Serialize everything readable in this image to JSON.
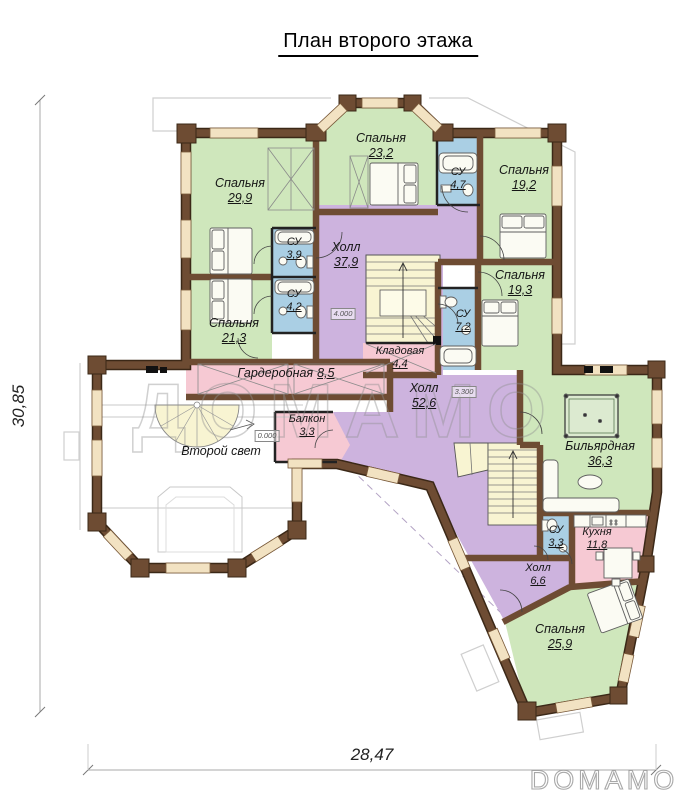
{
  "title": "План второго этажа",
  "dimensions": {
    "left": "30,85",
    "bottom": "28,47"
  },
  "watermark": {
    "center": "ДОМАМО",
    "corner": "DOMAMO"
  },
  "elevations": [
    "4.000",
    "3.300",
    "0.000"
  ],
  "colors": {
    "wall": "#6e4c33",
    "wall_edge": "#3b2817",
    "bedroom": "#cfe7bc",
    "hall": "#cdb3de",
    "bathroom": "#aacfe4",
    "service": "#f6c9d3",
    "stairs": "#f8f4d2",
    "window": "#f2e2c2"
  },
  "rooms": [
    {
      "id": "bedroom-29-9",
      "name": "Спальня",
      "area": "29,9",
      "type": "bedroom"
    },
    {
      "id": "bedroom-23-2",
      "name": "Спальня",
      "area": "23,2",
      "type": "bedroom"
    },
    {
      "id": "bathroom-4-7",
      "name": "СУ",
      "area": "4,7",
      "type": "bathroom"
    },
    {
      "id": "bedroom-19-2",
      "name": "Спальня",
      "area": "19,2",
      "type": "bedroom"
    },
    {
      "id": "hall-37-9",
      "name": "Холл",
      "area": "37,9",
      "type": "hall"
    },
    {
      "id": "bathroom-3-9",
      "name": "СУ",
      "area": "3,9",
      "type": "bathroom"
    },
    {
      "id": "bathroom-4-2",
      "name": "СУ",
      "area": "4,2",
      "type": "bathroom"
    },
    {
      "id": "bedroom-21-3",
      "name": "Спальня",
      "area": "21,3",
      "type": "bedroom"
    },
    {
      "id": "bedroom-19-3",
      "name": "Спальня",
      "area": "19,3",
      "type": "bedroom"
    },
    {
      "id": "bathroom-7-2",
      "name": "СУ",
      "area": "7,2",
      "type": "bathroom"
    },
    {
      "id": "storage-4-4",
      "name": "Кладовая",
      "area": "4,4",
      "type": "service"
    },
    {
      "id": "wardrobe-8-5",
      "name": "Гардеробная",
      "area": "8,5",
      "type": "service"
    },
    {
      "id": "hall-52-6",
      "name": "Холл",
      "area": "52,6",
      "type": "hall"
    },
    {
      "id": "balcony-3-3",
      "name": "Балкон",
      "area": "3,3",
      "type": "service"
    },
    {
      "id": "second-light",
      "name": "Второй свет",
      "area": "",
      "type": "void"
    },
    {
      "id": "billiard-36-3",
      "name": "Бильярдная",
      "area": "36,3",
      "type": "leisure"
    },
    {
      "id": "bathroom-3-3",
      "name": "СУ",
      "area": "3,3",
      "type": "bathroom"
    },
    {
      "id": "kitchen-11-8",
      "name": "Кухня",
      "area": "11,8",
      "type": "kitchen"
    },
    {
      "id": "hall-6-6",
      "name": "Холл",
      "area": "6,6",
      "type": "hall"
    },
    {
      "id": "bedroom-25-9",
      "name": "Спальня",
      "area": "25,9",
      "type": "bedroom"
    }
  ]
}
